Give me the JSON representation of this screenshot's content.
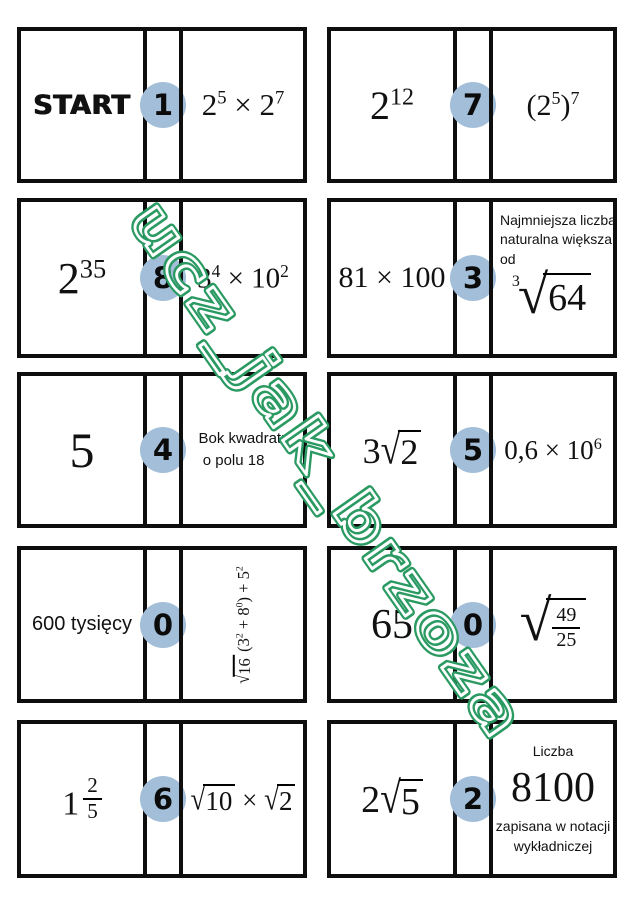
{
  "theme": {
    "badge_color": "#a3bed8",
    "border_color": "#0e0e0e",
    "watermark_green": "#2a9a62",
    "background": "#ffffff"
  },
  "watermark": {
    "text": "ucz_jak_brzoza"
  },
  "cards": [
    {
      "number": "1",
      "left_html": "START",
      "right_html": "2<sup>5</sup> × 2<sup>7</sup>"
    },
    {
      "number": "7",
      "left_html": "2<sup>12</sup>",
      "right_html": "(2<sup>5</sup>)<sup>7</sup>"
    },
    {
      "number": "8",
      "left_html": "2<sup>35</sup>",
      "right_html": "3<sup>4</sup> × 10<sup>2</sup>"
    },
    {
      "number": "3",
      "left_html": "81 × 100",
      "right_text_html": "Najmniejsza liczba<br>naturalna większa<br>od",
      "right_math_html": "<span class='cuberoot'><sup class='idx'>3</sup><span class='rsign'>√</span><span class='rad'>64</span></span>"
    },
    {
      "number": "4",
      "left_html": "5",
      "right_html": "Bok kwadratu<br>&nbsp;o polu 18"
    },
    {
      "number": "5",
      "left_html": "3<span class='rsign'>√</span><span class='rad'>2</span>",
      "right_html": "0,6 × 10<sup>6</sup>"
    },
    {
      "number": "0",
      "left_html": "600 tysięcy",
      "right_html": "<span class='rsign'>√</span><span class='rad'>16</span>&#8201;(3<sup>2</sup> + 8<sup>0</sup>) + 5<sup>2</sup>"
    },
    {
      "number": "0",
      "left_html": "65",
      "right_html": "<span class='bigsq'><span class='rsign big'>√</span><span class='rad'><span class='frac'><span class='num'>49</span><span class='den'>25</span></span></span></span>"
    },
    {
      "number": "6",
      "left_html": "1<span class='frac mixed'><span class='num'>2</span><span class='den'>5</span></span>",
      "right_html": "<span class='rsign'>√</span><span class='rad'>10</span> × <span class='rsign'>√</span><span class='rad'>2</span>"
    },
    {
      "number": "2",
      "left_html": "2<span class='rsign'>√</span><span class='rad'>5</span>",
      "right_top": "Liczba",
      "right_big": "8100",
      "right_bottom_html": "zapisana w notacji<br>wykładniczej"
    }
  ]
}
